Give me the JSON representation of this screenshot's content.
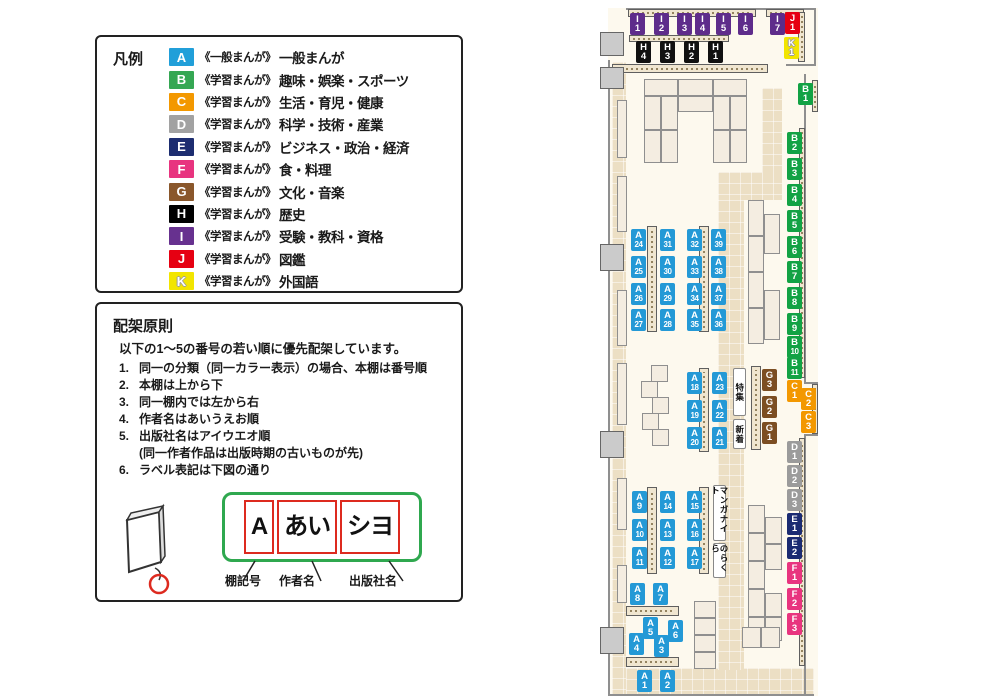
{
  "legend": {
    "title": "凡例",
    "items": [
      {
        "code": "A",
        "color": "#219fd9",
        "series": "《一般まんが》",
        "label": "一般まんが"
      },
      {
        "code": "B",
        "color": "#35a753",
        "series": "《学習まんが》",
        "label": "趣味・娯楽・スポーツ"
      },
      {
        "code": "C",
        "color": "#f39800",
        "series": "《学習まんが》",
        "label": "生活・育児・健康"
      },
      {
        "code": "D",
        "color": "#a2a2a2",
        "series": "《学習まんが》",
        "label": "科学・技術・産業"
      },
      {
        "code": "E",
        "color": "#1d2d70",
        "series": "《学習まんが》",
        "label": "ビジネス・政治・経済"
      },
      {
        "code": "F",
        "color": "#e8347f",
        "series": "《学習まんが》",
        "label": "食・料理"
      },
      {
        "code": "G",
        "color": "#8a572b",
        "series": "《学習まんが》",
        "label": "文化・音楽"
      },
      {
        "code": "H",
        "color": "#000000",
        "series": "《学習まんが》",
        "label": "歴史"
      },
      {
        "code": "I",
        "color": "#67318f",
        "series": "《学習まんが》",
        "label": "受験・教科・資格"
      },
      {
        "code": "J",
        "color": "#e60012",
        "series": "《学習まんが》",
        "label": "図鑑"
      },
      {
        "code": "K",
        "color": "#f2e500",
        "outlined": true,
        "series": "《学習まんが》",
        "label": "外国語"
      }
    ]
  },
  "principles": {
    "title": "配架原則",
    "intro": "以下の1〜5の番号の若い順に優先配架しています。",
    "rules": [
      {
        "num": "1.",
        "text": "同一の分類（同一カラー表示）の場合、本棚は番号順"
      },
      {
        "num": "2.",
        "text": "本棚は上から下"
      },
      {
        "num": "3.",
        "text": "同一棚内では左から右"
      },
      {
        "num": "4.",
        "text": "作者名はあいうえお順"
      },
      {
        "num": "5.",
        "text": "出版社名はアイウエオ順",
        "sub": "(同一作者作品は出版時期の古いものが先)"
      },
      {
        "num": "6.",
        "text": "ラベル表記は下図の通り"
      }
    ],
    "label_example": {
      "boxes": [
        "A",
        "あい",
        "シヨ"
      ],
      "captions": [
        "棚記号",
        "作者名",
        "出版社名"
      ],
      "frame_color": "#2fa84f",
      "box_border_color": "#dd2a1f"
    }
  },
  "map": {
    "colors": {
      "A": "#2499d6",
      "B": "#12a244",
      "C": "#f39800",
      "D": "#9b9b9b",
      "E": "#1b2b72",
      "F": "#e8347f",
      "G": "#7c4e22",
      "H": "#111111",
      "I": "#5e2c8b",
      "J": "#e60012",
      "K": "#f2e500"
    },
    "shelf_labels": [
      {
        "code": "I1",
        "x": 630,
        "y": 13
      },
      {
        "code": "I2",
        "x": 654,
        "y": 13
      },
      {
        "code": "I3",
        "x": 677,
        "y": 13
      },
      {
        "code": "I4",
        "x": 695,
        "y": 13
      },
      {
        "code": "I5",
        "x": 716,
        "y": 13
      },
      {
        "code": "I6",
        "x": 738,
        "y": 13
      },
      {
        "code": "I7",
        "x": 770,
        "y": 13
      },
      {
        "code": "J1",
        "x": 785,
        "y": 12
      },
      {
        "code": "K1",
        "x": 784,
        "y": 37
      },
      {
        "code": "H4",
        "x": 636,
        "y": 41
      },
      {
        "code": "H3",
        "x": 660,
        "y": 41
      },
      {
        "code": "H2",
        "x": 684,
        "y": 41
      },
      {
        "code": "H1",
        "x": 708,
        "y": 41
      },
      {
        "code": "B1",
        "x": 798,
        "y": 83
      },
      {
        "code": "B2",
        "x": 787,
        "y": 132
      },
      {
        "code": "B3",
        "x": 787,
        "y": 158
      },
      {
        "code": "B4",
        "x": 787,
        "y": 184
      },
      {
        "code": "B5",
        "x": 787,
        "y": 210
      },
      {
        "code": "B6",
        "x": 787,
        "y": 236
      },
      {
        "code": "B7",
        "x": 787,
        "y": 261
      },
      {
        "code": "B8",
        "x": 787,
        "y": 287
      },
      {
        "code": "B9",
        "x": 787,
        "y": 313
      },
      {
        "code": "B10",
        "x": 787,
        "y": 336
      },
      {
        "code": "B11",
        "x": 787,
        "y": 357
      },
      {
        "code": "C1",
        "x": 787,
        "y": 380
      },
      {
        "code": "C2",
        "x": 801,
        "y": 388
      },
      {
        "code": "C3",
        "x": 801,
        "y": 411
      },
      {
        "code": "D1",
        "x": 787,
        "y": 441
      },
      {
        "code": "D2",
        "x": 787,
        "y": 465
      },
      {
        "code": "D3",
        "x": 787,
        "y": 489
      },
      {
        "code": "E1",
        "x": 787,
        "y": 513
      },
      {
        "code": "E2",
        "x": 787,
        "y": 537
      },
      {
        "code": "F1",
        "x": 787,
        "y": 562
      },
      {
        "code": "F2",
        "x": 787,
        "y": 588
      },
      {
        "code": "F3",
        "x": 787,
        "y": 613
      },
      {
        "code": "G3",
        "x": 762,
        "y": 369
      },
      {
        "code": "G2",
        "x": 762,
        "y": 396
      },
      {
        "code": "G1",
        "x": 762,
        "y": 422
      },
      {
        "code": "A24",
        "x": 631,
        "y": 229
      },
      {
        "code": "A31",
        "x": 660,
        "y": 229
      },
      {
        "code": "A32",
        "x": 687,
        "y": 229
      },
      {
        "code": "A39",
        "x": 711,
        "y": 229
      },
      {
        "code": "A25",
        "x": 631,
        "y": 256
      },
      {
        "code": "A30",
        "x": 660,
        "y": 256
      },
      {
        "code": "A33",
        "x": 687,
        "y": 256
      },
      {
        "code": "A38",
        "x": 711,
        "y": 256
      },
      {
        "code": "A26",
        "x": 631,
        "y": 283
      },
      {
        "code": "A29",
        "x": 660,
        "y": 283
      },
      {
        "code": "A34",
        "x": 687,
        "y": 283
      },
      {
        "code": "A37",
        "x": 711,
        "y": 283
      },
      {
        "code": "A27",
        "x": 631,
        "y": 309
      },
      {
        "code": "A28",
        "x": 660,
        "y": 309
      },
      {
        "code": "A35",
        "x": 687,
        "y": 309
      },
      {
        "code": "A36",
        "x": 711,
        "y": 309
      },
      {
        "code": "A18",
        "x": 687,
        "y": 372
      },
      {
        "code": "A23",
        "x": 712,
        "y": 372
      },
      {
        "code": "A19",
        "x": 687,
        "y": 400
      },
      {
        "code": "A22",
        "x": 712,
        "y": 400
      },
      {
        "code": "A20",
        "x": 687,
        "y": 427
      },
      {
        "code": "A21",
        "x": 712,
        "y": 427
      },
      {
        "code": "A9",
        "x": 632,
        "y": 491
      },
      {
        "code": "A14",
        "x": 660,
        "y": 491
      },
      {
        "code": "A15",
        "x": 687,
        "y": 491
      },
      {
        "code": "A10",
        "x": 632,
        "y": 519
      },
      {
        "code": "A13",
        "x": 660,
        "y": 519
      },
      {
        "code": "A16",
        "x": 687,
        "y": 519
      },
      {
        "code": "A11",
        "x": 632,
        "y": 547
      },
      {
        "code": "A12",
        "x": 660,
        "y": 547
      },
      {
        "code": "A17",
        "x": 687,
        "y": 547
      },
      {
        "code": "A8",
        "x": 630,
        "y": 583
      },
      {
        "code": "A7",
        "x": 653,
        "y": 583
      },
      {
        "code": "A5",
        "x": 643,
        "y": 617
      },
      {
        "code": "A6",
        "x": 668,
        "y": 620
      },
      {
        "code": "A4",
        "x": 629,
        "y": 633
      },
      {
        "code": "A3",
        "x": 654,
        "y": 635
      },
      {
        "code": "A1",
        "x": 637,
        "y": 670
      },
      {
        "code": "A2",
        "x": 660,
        "y": 670
      }
    ],
    "signs": [
      {
        "text": "特集",
        "x": 733,
        "y": 368,
        "w": 13,
        "h": 48
      },
      {
        "text": "新着",
        "x": 733,
        "y": 419,
        "w": 13,
        "h": 30
      },
      {
        "text": "マンガナイト",
        "x": 713,
        "y": 485,
        "w": 13,
        "h": 56
      },
      {
        "text": "のらくら",
        "x": 713,
        "y": 543,
        "w": 13,
        "h": 35
      }
    ]
  }
}
